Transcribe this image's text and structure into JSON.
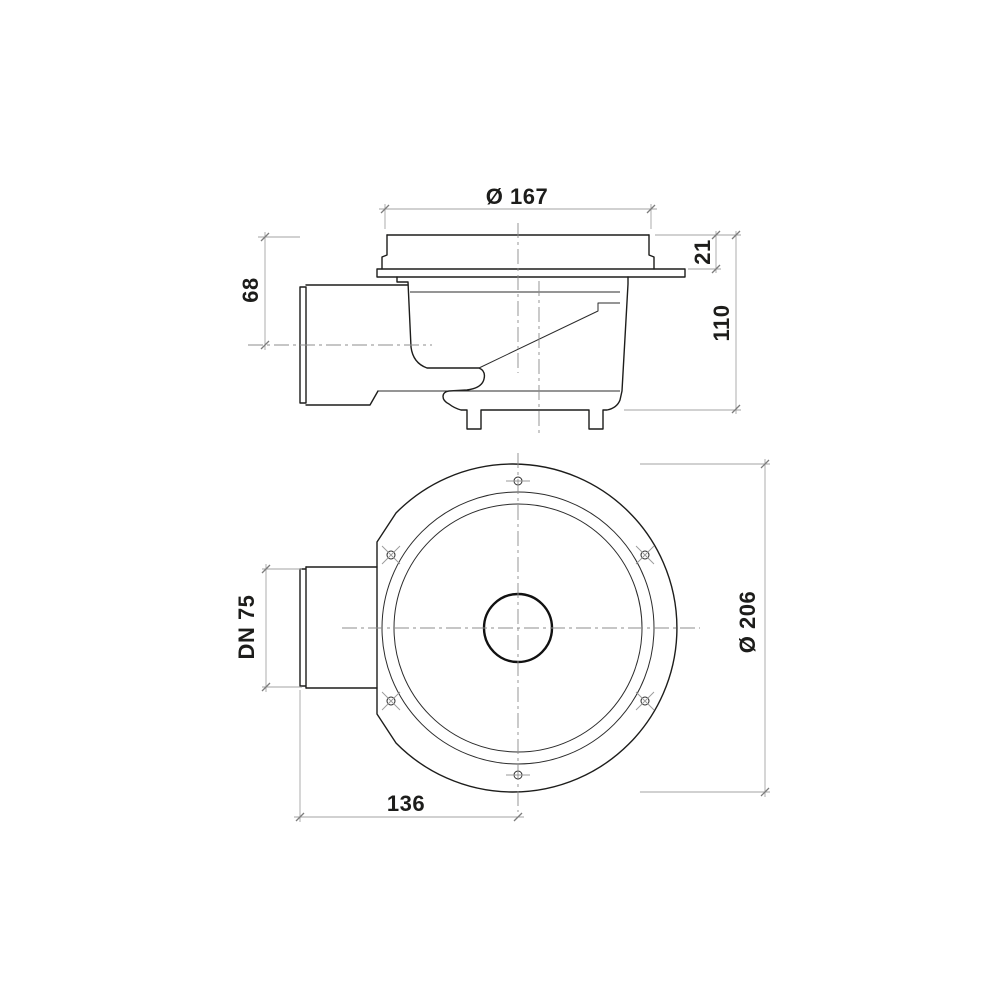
{
  "drawing": {
    "kind": "floor-drain-technical-drawing",
    "views": {
      "side": {
        "dimensions": {
          "grate_diameter": "Ø 167",
          "grate_height": "21",
          "body_height": "110",
          "outlet_axis_height": "68"
        }
      },
      "plan": {
        "dimensions": {
          "outlet_nominal_diameter": "DN 75",
          "flange_diameter": "Ø 206",
          "outlet_projection": "136"
        }
      }
    },
    "style": {
      "background": "#ffffff",
      "line_color": "#1d1d1b",
      "dimension_line_color": "#a3a3a3",
      "centerline_color": "#8c8c8c",
      "text_color": "#1d1d1b"
    }
  }
}
